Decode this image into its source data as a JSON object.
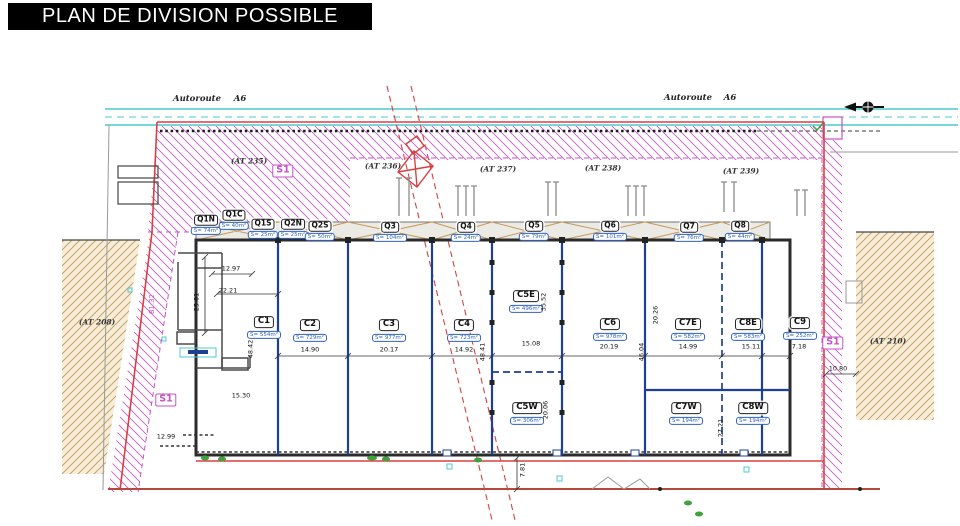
{
  "title": "PLAN DE DIVISION POSSIBLE",
  "colors": {
    "c-title-bg": "#000000",
    "c-title-fg": "#ffffff",
    "c-red": "#d94040",
    "c-darkred": "#b3493b",
    "c-magenta": "#c653c6",
    "c-cyan": "#4cc8d2",
    "c-tan": "#c59a5a",
    "c-tan-bg": "#f6edd8",
    "c-blue": "#1e3f96",
    "c-blue-label": "#2f62c4",
    "c-green": "#3fa23f"
  },
  "road": {
    "labels": [
      {
        "text": "Autoroute",
        "x": 197,
        "y": 100
      },
      {
        "text": "A6",
        "x": 240,
        "y": 100
      },
      {
        "text": "Autoroute",
        "x": 688,
        "y": 99
      },
      {
        "text": "A6",
        "x": 730,
        "y": 99
      }
    ]
  },
  "parcels": [
    {
      "label": "(AT 235)",
      "x": 249,
      "y": 162
    },
    {
      "label": "(AT 236)",
      "x": 383,
      "y": 167
    },
    {
      "label": "(AT 237)",
      "x": 498,
      "y": 170
    },
    {
      "label": "(AT 238)",
      "x": 603,
      "y": 169
    },
    {
      "label": "(AT 239)",
      "x": 741,
      "y": 172
    },
    {
      "label": "(AT 208)",
      "x": 97,
      "y": 323
    },
    {
      "label": "(AT 210)",
      "x": 888,
      "y": 342
    }
  ],
  "zones": {
    "label": "S1",
    "positions": [
      {
        "x": 283,
        "y": 171
      },
      {
        "x": 166,
        "y": 400
      },
      {
        "x": 833,
        "y": 343
      }
    ]
  },
  "q_units": [
    {
      "name": "Q1N",
      "area": "S= 74m²",
      "x": 206,
      "y": 220
    },
    {
      "name": "Q1C",
      "area": "S= 40m²",
      "x": 234,
      "y": 215
    },
    {
      "name": "Q1S",
      "area": "S= 25m²",
      "x": 263,
      "y": 224
    },
    {
      "name": "Q2N",
      "area": "S= 25m²",
      "x": 293,
      "y": 224
    },
    {
      "name": "Q2S",
      "area": "S= 50m²",
      "x": 320,
      "y": 226
    },
    {
      "name": "Q3",
      "area": "S= 104m²",
      "x": 390,
      "y": 227
    },
    {
      "name": "Q4",
      "area": "S= 24m²",
      "x": 466,
      "y": 227
    },
    {
      "name": "Q5",
      "area": "S= 79m²",
      "x": 534,
      "y": 226
    },
    {
      "name": "Q6",
      "area": "S= 101m²",
      "x": 610,
      "y": 226
    },
    {
      "name": "Q7",
      "area": "S= 76m²",
      "x": 689,
      "y": 227
    },
    {
      "name": "Q8",
      "area": "S= 44m²",
      "x": 740,
      "y": 226
    }
  ],
  "c_units": [
    {
      "name": "C1",
      "area": "S= 554m²",
      "x": 264,
      "y": 322
    },
    {
      "name": "C2",
      "area": "S= 729m²",
      "x": 310,
      "y": 325
    },
    {
      "name": "C3",
      "area": "S= 977m²",
      "x": 389,
      "y": 325
    },
    {
      "name": "C4",
      "area": "S= 723m²",
      "x": 464,
      "y": 325
    },
    {
      "name": "C5E",
      "area": "S= 496m²",
      "x": 526,
      "y": 296
    },
    {
      "name": "C5W",
      "area": "S= 306m²",
      "x": 527,
      "y": 408
    },
    {
      "name": "C6",
      "area": "S= 978m²",
      "x": 610,
      "y": 324
    },
    {
      "name": "C7E",
      "area": "S= 582m²",
      "x": 688,
      "y": 324
    },
    {
      "name": "C8E",
      "area": "S= 583m²",
      "x": 748,
      "y": 324
    },
    {
      "name": "C9",
      "area": "S= 252m²",
      "x": 800,
      "y": 323
    },
    {
      "name": "C7W",
      "area": "S= 194m²",
      "x": 686,
      "y": 408
    },
    {
      "name": "C8W",
      "area": "S= 194m²",
      "x": 753,
      "y": 408
    }
  ],
  "dimensions": [
    {
      "t": "12.97",
      "x": 231,
      "y": 269,
      "r": 0
    },
    {
      "t": "22.21",
      "x": 228,
      "y": 291,
      "r": 0
    },
    {
      "t": "25.01",
      "x": 197,
      "y": 302,
      "r": -90
    },
    {
      "t": "48.42",
      "x": 251,
      "y": 349,
      "r": -90
    },
    {
      "t": "15.30",
      "x": 241,
      "y": 396,
      "r": 0
    },
    {
      "t": "12.99",
      "x": 166,
      "y": 437,
      "r": 0
    },
    {
      "t": "14.90",
      "x": 310,
      "y": 350,
      "r": 0
    },
    {
      "t": "20.17",
      "x": 389,
      "y": 350,
      "r": 0
    },
    {
      "t": "14.92",
      "x": 464,
      "y": 350,
      "r": 0
    },
    {
      "t": "48.41",
      "x": 483,
      "y": 352,
      "r": -90
    },
    {
      "t": "15.08",
      "x": 531,
      "y": 344,
      "r": 0
    },
    {
      "t": "35.52",
      "x": 544,
      "y": 302,
      "r": -90
    },
    {
      "t": "20.06",
      "x": 546,
      "y": 410,
      "r": -90
    },
    {
      "t": "20.19",
      "x": 609,
      "y": 347,
      "r": 0
    },
    {
      "t": "46.04",
      "x": 642,
      "y": 352,
      "r": -90
    },
    {
      "t": "20.26",
      "x": 656,
      "y": 315,
      "r": -90
    },
    {
      "t": "14.99",
      "x": 688,
      "y": 347,
      "r": 0
    },
    {
      "t": "15.11",
      "x": 751,
      "y": 347,
      "r": 0
    },
    {
      "t": "7.18",
      "x": 799,
      "y": 347,
      "r": 0
    },
    {
      "t": "27.21",
      "x": 721,
      "y": 428,
      "r": -90
    },
    {
      "t": "10.80",
      "x": 838,
      "y": 369,
      "r": 0
    },
    {
      "t": "7.81",
      "x": 523,
      "y": 470,
      "r": -90
    },
    {
      "t": "81.32",
      "x": 152,
      "y": 304,
      "r": -90,
      "magenta": true
    }
  ]
}
